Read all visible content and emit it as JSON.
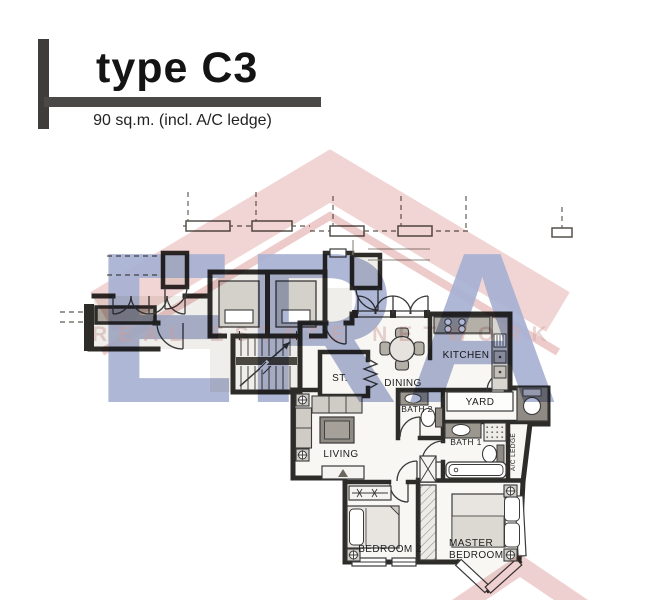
{
  "header": {
    "title": "type C3",
    "subtitle": "90 sq.m. (incl. A/C ledge)"
  },
  "watermark": {
    "brand": "ERA",
    "tagline": "REAL ESTATE NETWORK",
    "brand_color": "#8d99c4",
    "roof_color": "#edc7c7"
  },
  "floorplan": {
    "rooms": {
      "store": "ST.",
      "dining": "DINING",
      "kitchen": "KITCHEN",
      "yard": "YARD",
      "bath2": "BATH 2",
      "bath1": "BATH 1",
      "ac_ledge": "A/C LEDGE",
      "living": "LIVING",
      "bedroom2": "BEDROOM 2",
      "master_line1": "MASTER",
      "master_line2": "BEDROOM"
    }
  }
}
